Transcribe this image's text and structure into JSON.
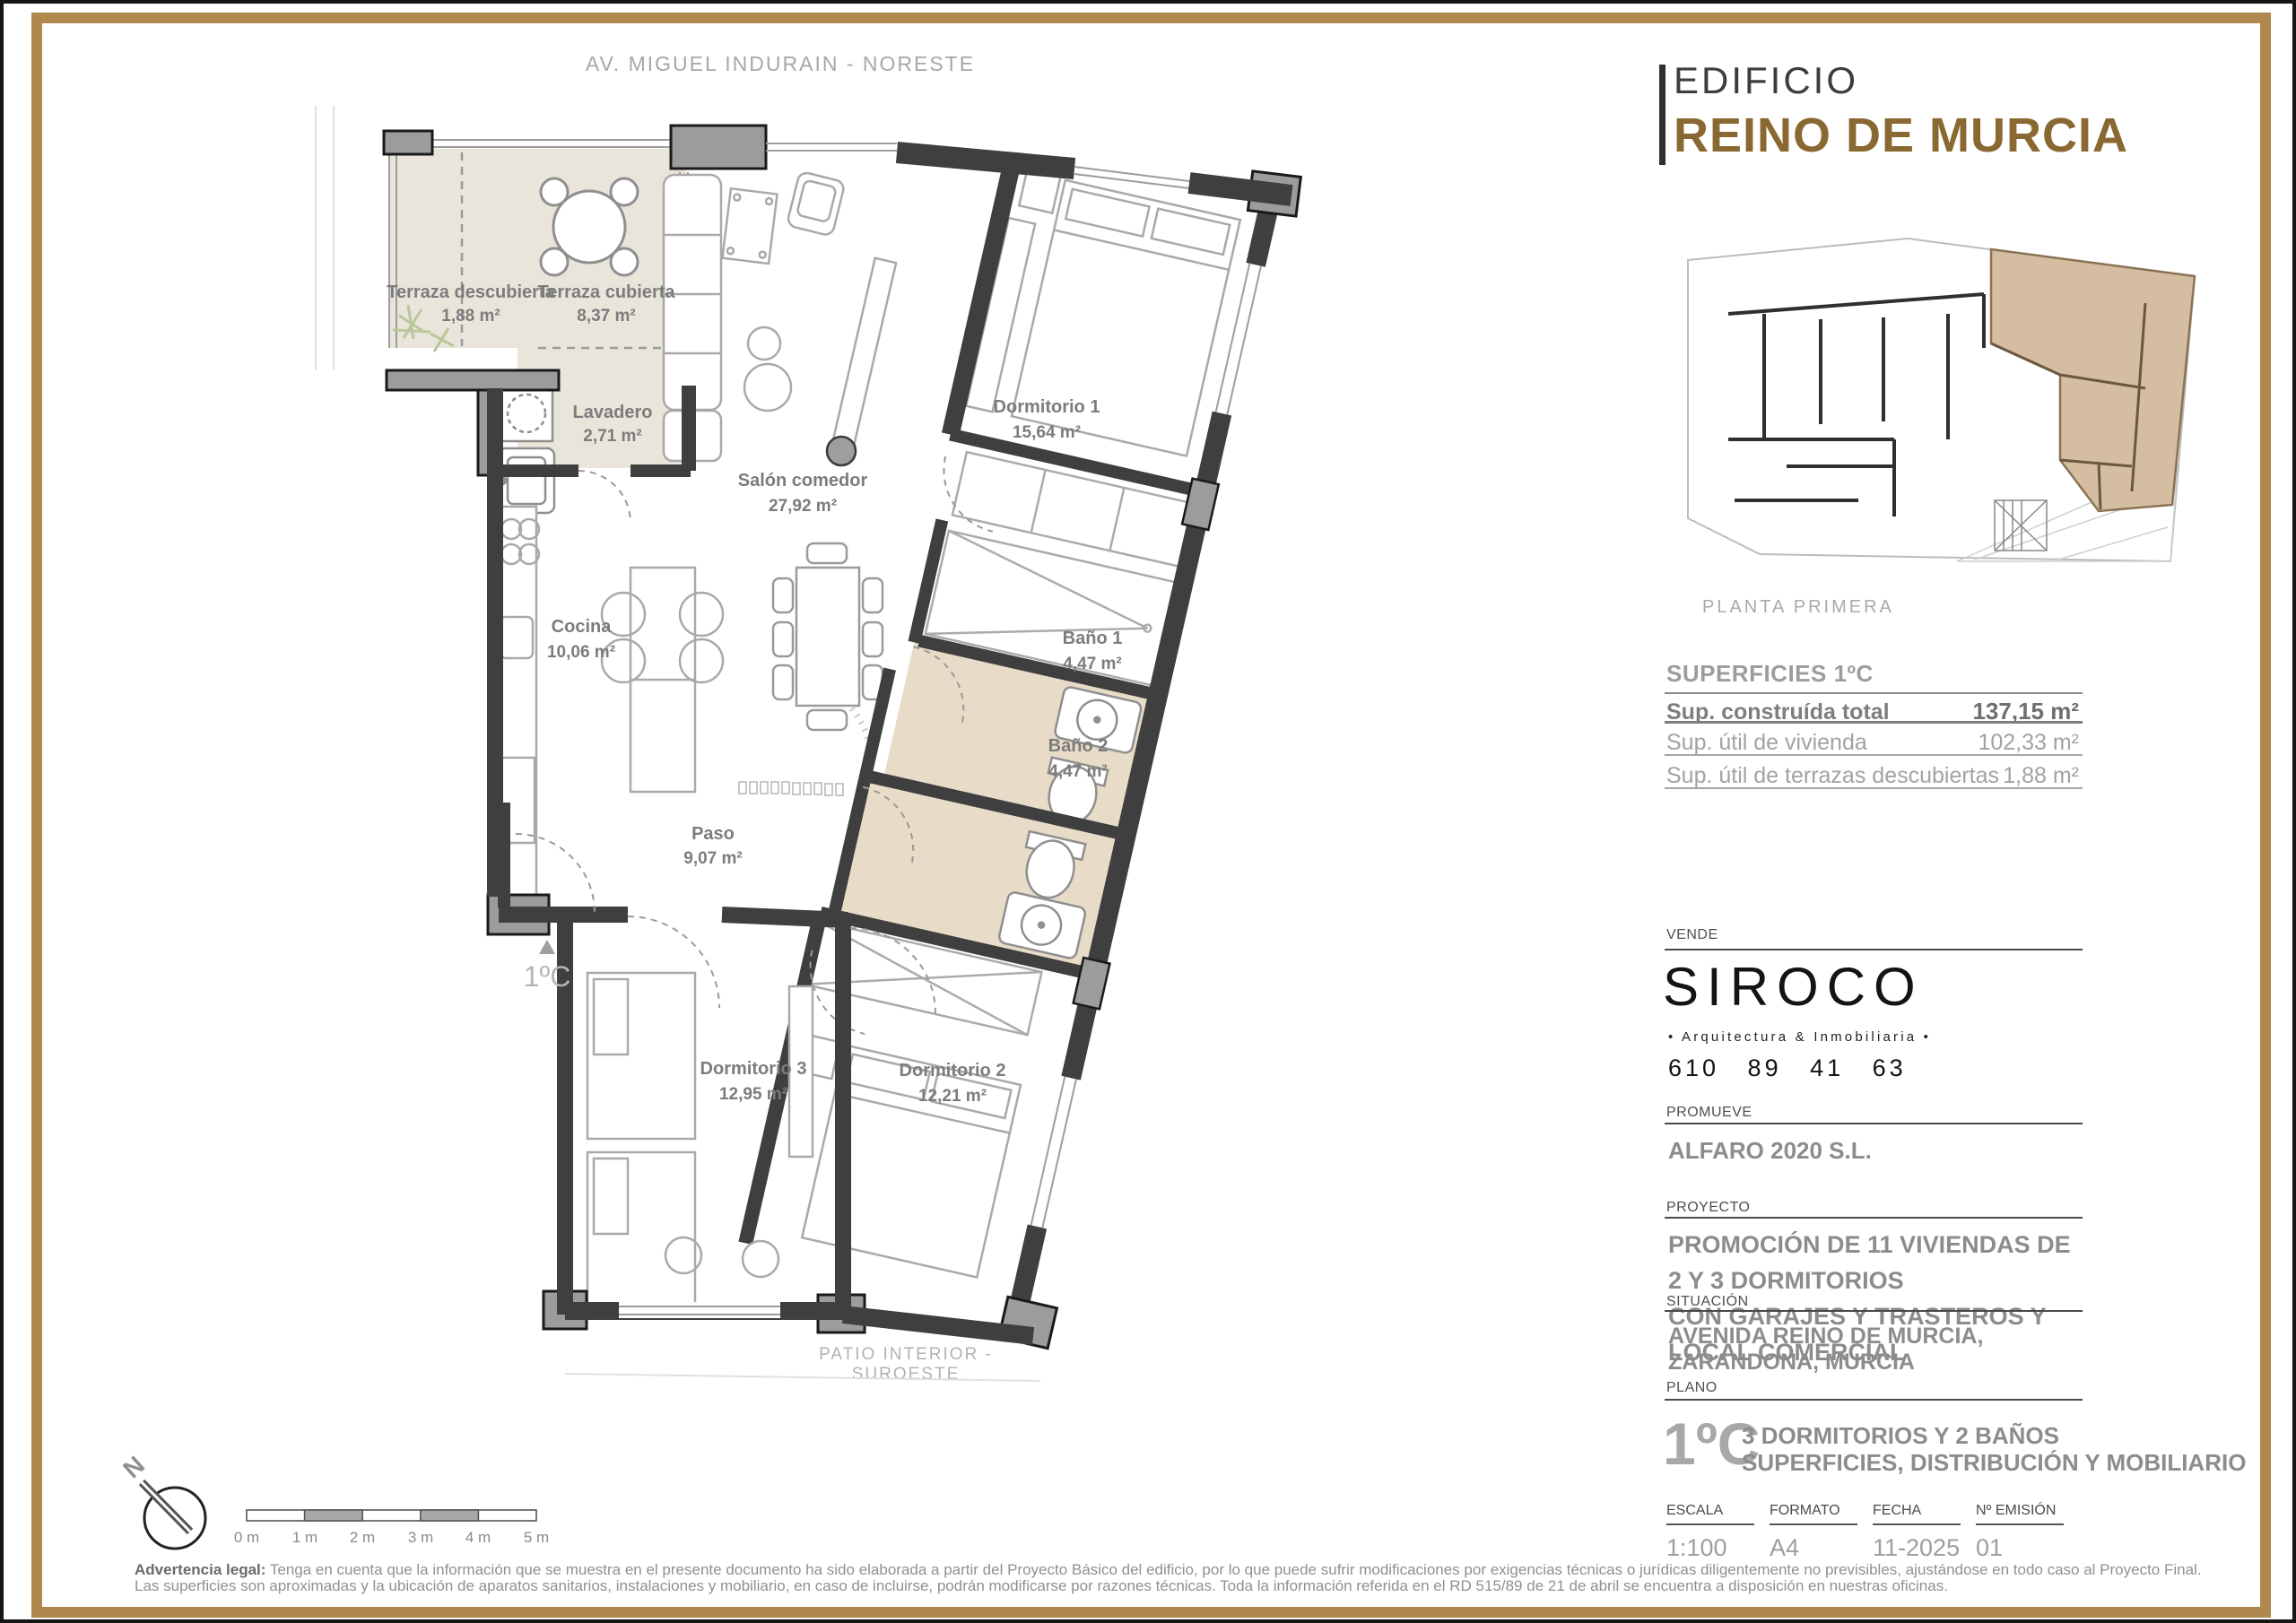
{
  "orientation": {
    "top_label": "AV. MIGUEL INDURAIN - NORESTE",
    "bottom_label": "PATIO INTERIOR - SUROESTE",
    "north_letter": "N"
  },
  "brand": {
    "prefix": "EDIFICIO",
    "name": "REINO DE MURCIA"
  },
  "keyplan": {
    "caption": "PLANTA PRIMERA"
  },
  "plan": {
    "unit_marker": "1ºC",
    "rooms": [
      {
        "name": "Terraza descubierta",
        "area": "1,88 m²"
      },
      {
        "name": "Terraza cubierta",
        "area": "8,37 m²"
      },
      {
        "name": "Lavadero",
        "area": "2,71 m²"
      },
      {
        "name": "Salón comedor",
        "area": "27,92 m²"
      },
      {
        "name": "Cocina",
        "area": "10,06 m²"
      },
      {
        "name": "Dormitorio 1",
        "area": "15,64 m²"
      },
      {
        "name": "Baño 1",
        "area": "4,47 m²"
      },
      {
        "name": "Baño 2",
        "area": "4,47 m²"
      },
      {
        "name": "Paso",
        "area": "9,07 m²"
      },
      {
        "name": "Dormitorio 3",
        "area": "12,95 m²"
      },
      {
        "name": "Dormitorio 2",
        "area": "12,21 m²"
      }
    ]
  },
  "superficies": {
    "title": "SUPERFICIES 1ºC",
    "rows": [
      {
        "label": "Sup. construída total",
        "value": "137,15 m²"
      },
      {
        "label": "Sup. útil de vivienda",
        "value": "102,33 m²"
      },
      {
        "label": "Sup. útil de terrazas descubiertas",
        "value": "1,88 m²"
      }
    ]
  },
  "vende": {
    "label": "VENDE",
    "logo": "SIROCO",
    "tagline": "• Arquitectura & Inmobiliaria •",
    "phone": "610 89 41 63"
  },
  "promueve": {
    "label": "PROMUEVE",
    "value": "ALFARO 2020 S.L."
  },
  "proyecto": {
    "label": "PROYECTO",
    "line1": "PROMOCIÓN DE 11 VIVIENDAS DE 2 Y 3 DORMITORIOS",
    "line2": "CON GARAJES Y TRASTEROS Y LOCAL COMERCIAL"
  },
  "situacion": {
    "label": "SITUACIÓN",
    "value": "AVENIDA REINO DE MURCIA, ZARANDONA, MURCIA"
  },
  "plano": {
    "label": "PLANO",
    "unit": "1ºC",
    "line1": "3 DORMITORIOS Y 2 BAÑOS",
    "line2": "SUPERFICIES, DISTRIBUCIÓN Y MOBILIARIO"
  },
  "meta": {
    "columns": [
      {
        "label": "ESCALA",
        "value": "1:100"
      },
      {
        "label": "FORMATO",
        "value": "A4"
      },
      {
        "label": "FECHA",
        "value": "11-2025"
      },
      {
        "label": "Nº EMISIÓN",
        "value": "01"
      }
    ]
  },
  "scalebar": {
    "labels": [
      "0 m",
      "1 m",
      "2 m",
      "3 m",
      "4 m",
      "5 m"
    ]
  },
  "legal": {
    "prefix": "Advertencia legal:",
    "line1": "Tenga en cuenta que la información que se muestra en el presente documento ha sido elaborada a partir del Proyecto Básico del edificio, por lo que puede sufrir modificaciones por exigencias técnicas o jurídicas diligentemente no previsibles, ajustándose en todo caso al Proyecto Final.",
    "line2": "Las superficies son aproximadas y la ubicación de aparatos sanitarios, instalaciones y mobiliario, en caso de incluirse, podrán modificarse por razones técnicas. Toda la información referida en el RD 515/89 de 21 de abril se encuentra a disposición en nuestras oficinas."
  },
  "colors": {
    "frame": "#b0874f",
    "brand_brown": "#8a6831",
    "unit_highlight": "#d4bda1",
    "bath_fill": "#e8dcc8",
    "terrace_fill": "#eae5db",
    "wall": "#3f3f3f"
  }
}
